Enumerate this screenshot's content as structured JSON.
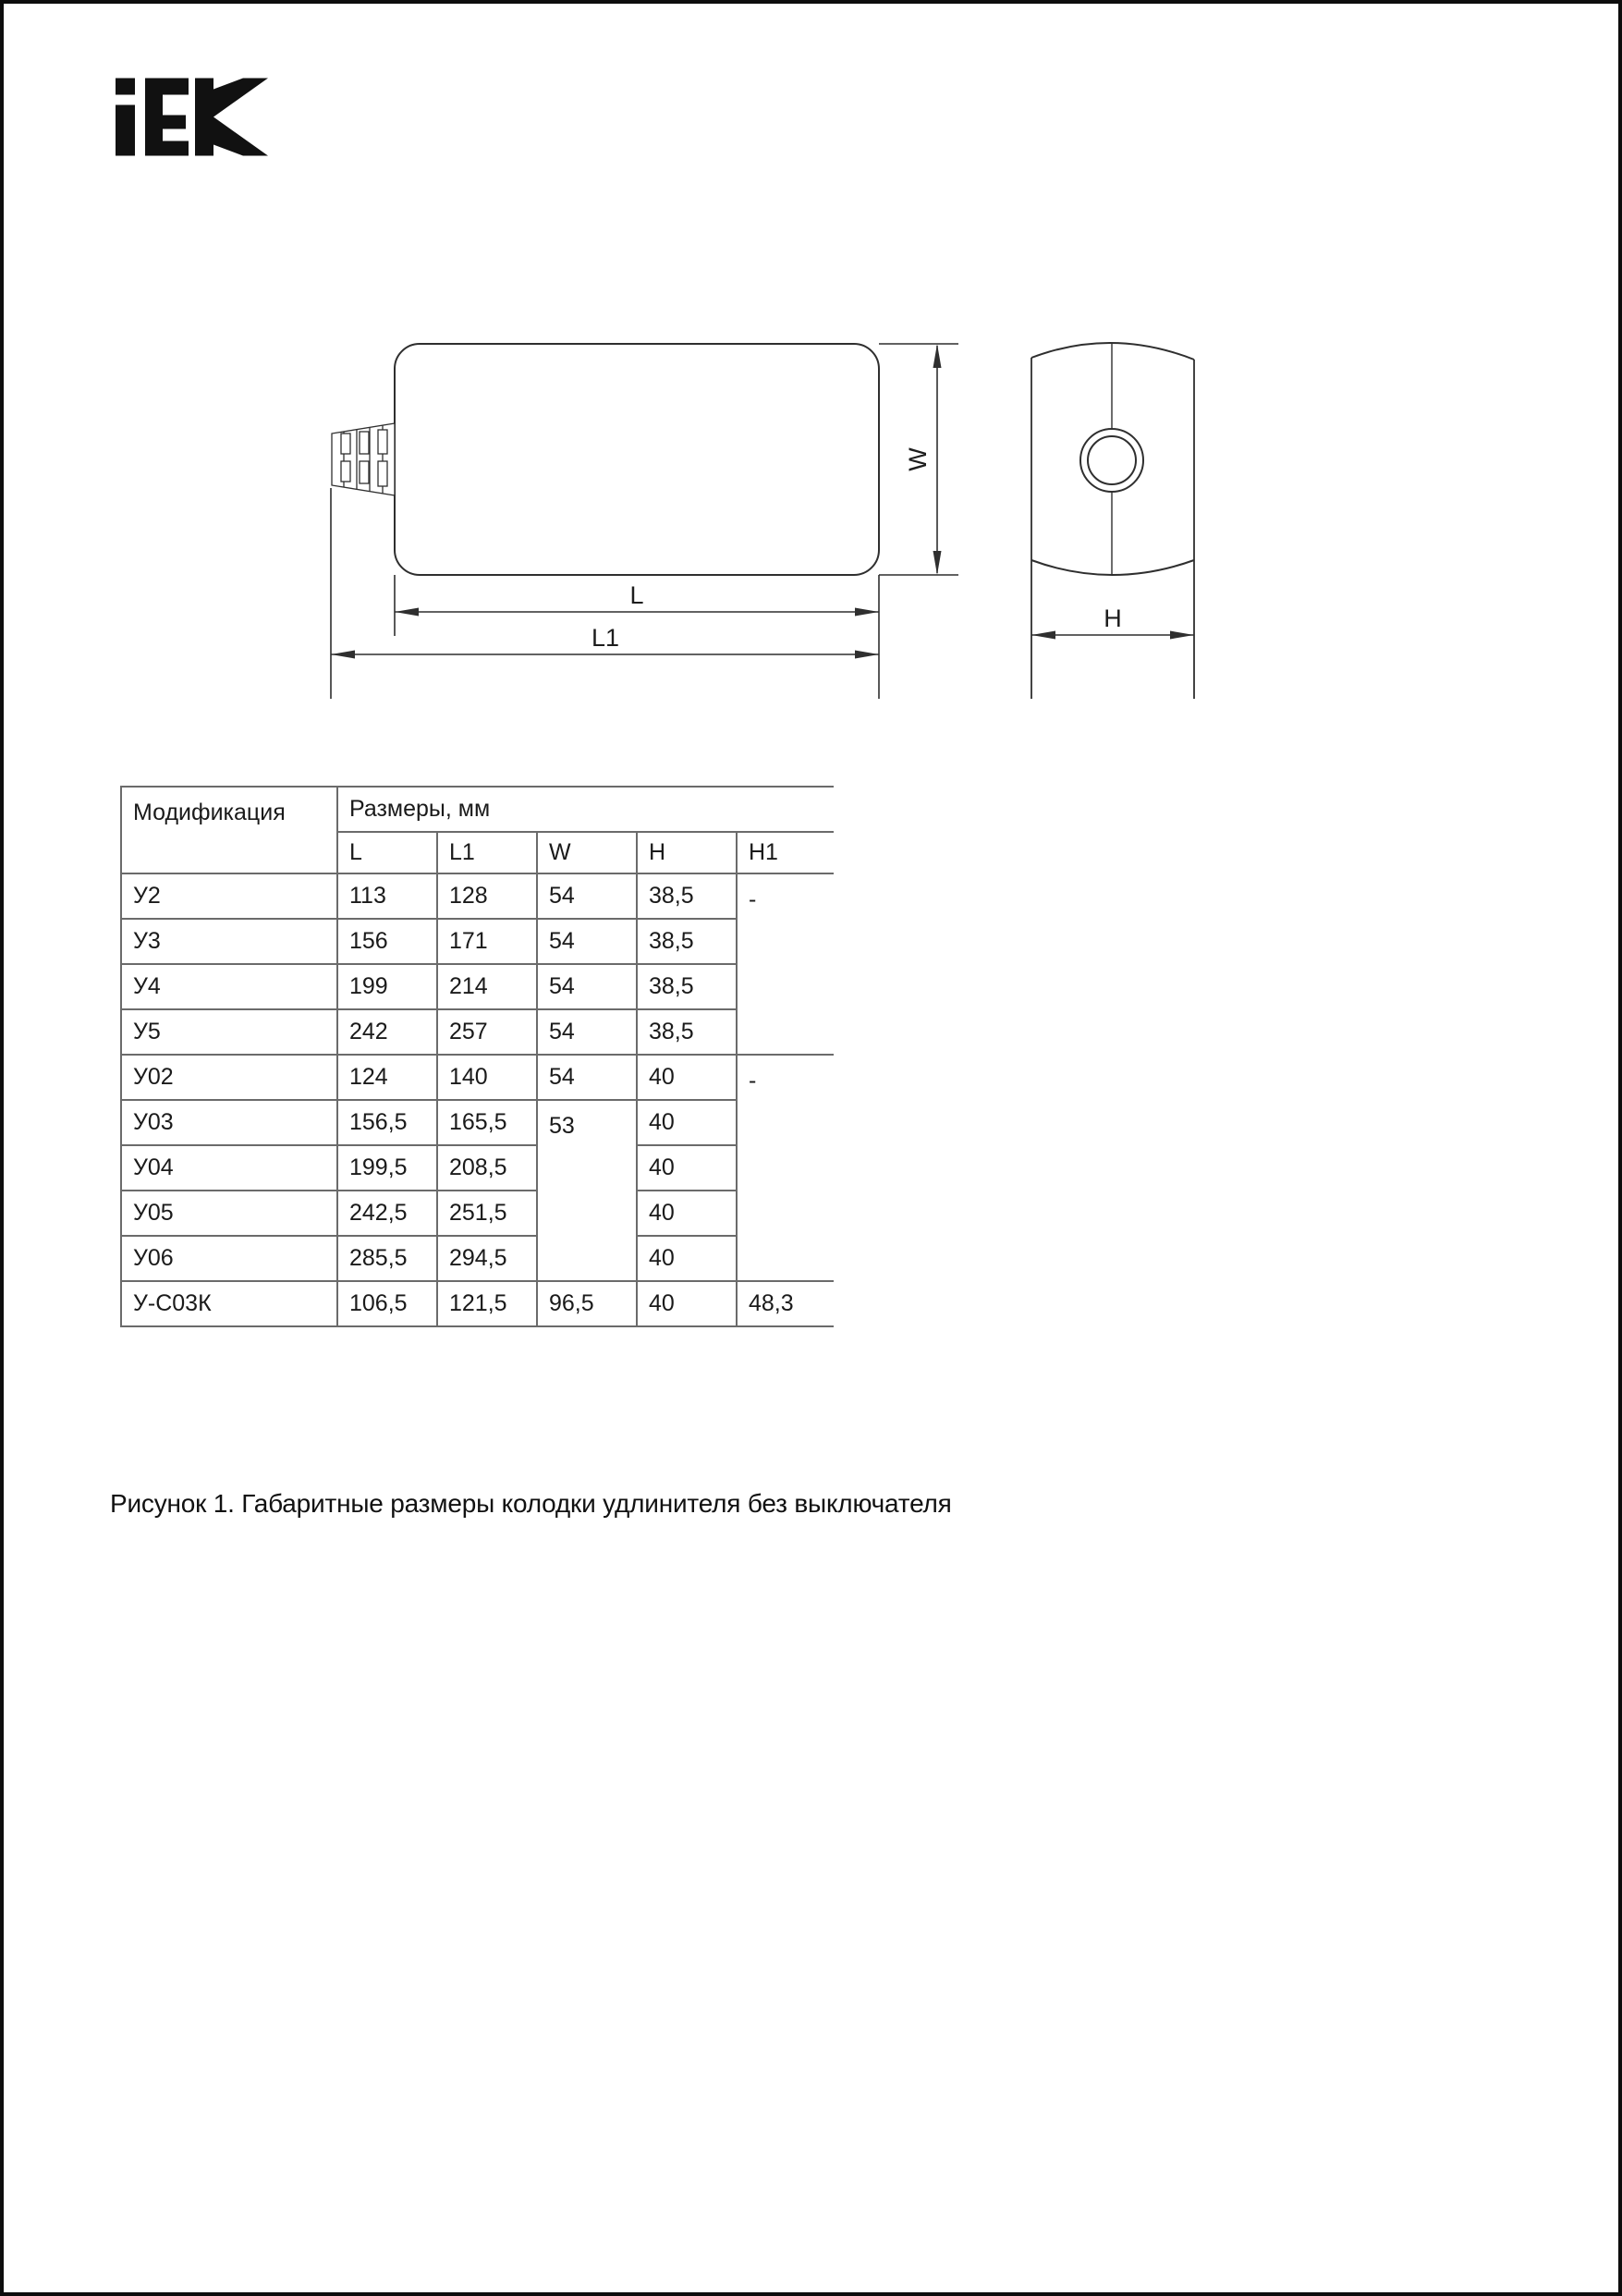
{
  "logo": {
    "text": "IEK"
  },
  "figure": {
    "labels": {
      "width": "W",
      "length": "L",
      "length_full": "L1",
      "height": "H"
    }
  },
  "table": {
    "header": {
      "modification": "Модификация",
      "dimensions_group": "Размеры, мм",
      "columns": [
        "L",
        "L1",
        "W",
        "H",
        "H1"
      ]
    },
    "rows": [
      {
        "cells": [
          {
            "t": "У2"
          },
          {
            "t": "113"
          },
          {
            "t": "128"
          },
          {
            "t": "54"
          },
          {
            "t": "38,5"
          },
          {
            "t": "-",
            "rowspan": 4,
            "top": true
          }
        ]
      },
      {
        "cells": [
          {
            "t": "У3"
          },
          {
            "t": "156"
          },
          {
            "t": "171"
          },
          {
            "t": "54"
          },
          {
            "t": "38,5"
          }
        ]
      },
      {
        "cells": [
          {
            "t": "У4"
          },
          {
            "t": "199"
          },
          {
            "t": "214"
          },
          {
            "t": "54"
          },
          {
            "t": "38,5"
          }
        ]
      },
      {
        "cells": [
          {
            "t": "У5"
          },
          {
            "t": "242"
          },
          {
            "t": "257"
          },
          {
            "t": "54"
          },
          {
            "t": "38,5"
          }
        ]
      },
      {
        "cells": [
          {
            "t": "У02"
          },
          {
            "t": "124"
          },
          {
            "t": "140"
          },
          {
            "t": "54"
          },
          {
            "t": "40"
          },
          {
            "t": "-",
            "rowspan": 5,
            "top": true
          }
        ]
      },
      {
        "cells": [
          {
            "t": "У03"
          },
          {
            "t": "156,5"
          },
          {
            "t": "165,5"
          },
          {
            "t": "53",
            "rowspan": 4,
            "top": true
          },
          {
            "t": "40"
          }
        ]
      },
      {
        "cells": [
          {
            "t": "У04"
          },
          {
            "t": "199,5"
          },
          {
            "t": "208,5"
          },
          {
            "t": "40"
          }
        ]
      },
      {
        "cells": [
          {
            "t": "У05"
          },
          {
            "t": "242,5"
          },
          {
            "t": "251,5"
          },
          {
            "t": "40"
          }
        ]
      },
      {
        "cells": [
          {
            "t": "У06"
          },
          {
            "t": "285,5"
          },
          {
            "t": "294,5"
          },
          {
            "t": "40"
          }
        ]
      },
      {
        "cells": [
          {
            "t": "У-С03К"
          },
          {
            "t": "106,5"
          },
          {
            "t": "121,5"
          },
          {
            "t": "96,5"
          },
          {
            "t": "40"
          },
          {
            "t": "48,3"
          }
        ]
      }
    ]
  },
  "caption": {
    "text": "Рисунок 1. Габаритные размеры колодки удлинителя без выключателя"
  },
  "colors": {
    "ink": "#161616",
    "drawing_line": "#2f2f2f",
    "table_line": "#6b6b6b",
    "page_border": "#0d0d0d",
    "logo": "#111111"
  }
}
